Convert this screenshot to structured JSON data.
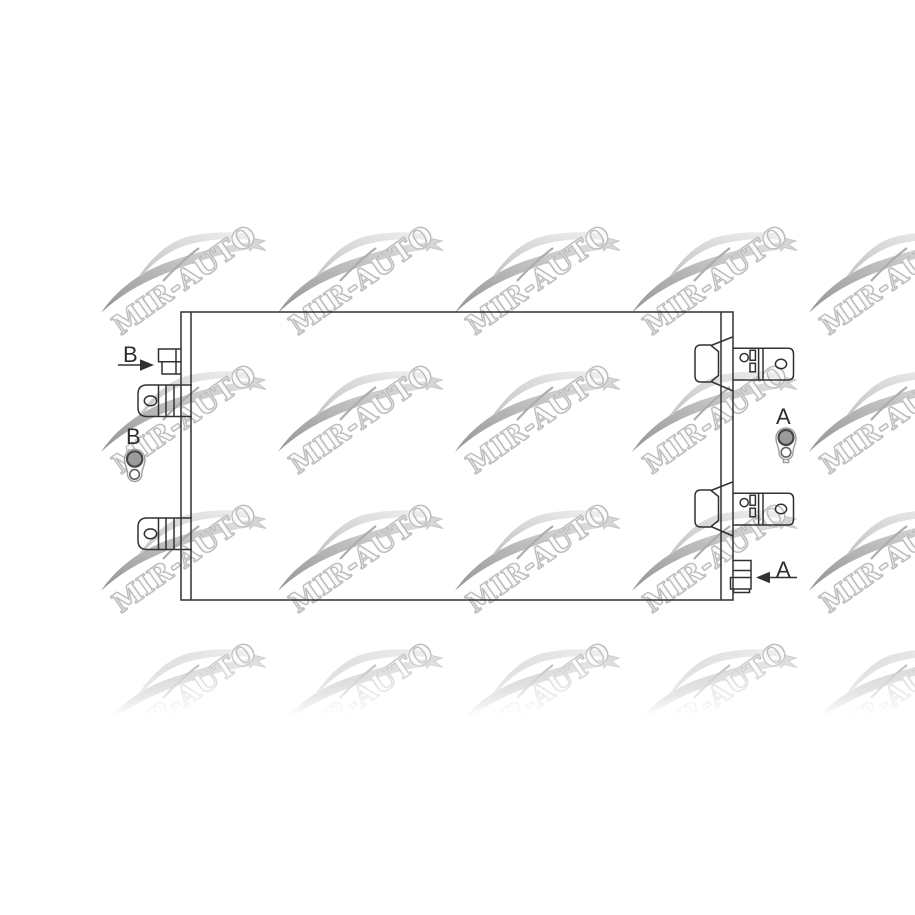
{
  "canvas": {
    "width": 915,
    "height": 915,
    "background": "#ffffff"
  },
  "watermark": {
    "text": "MIR-AUTO",
    "outline_color": "#bcbcbc",
    "swoosh_dark": "#949494",
    "swoosh_light": "#e3e3e3",
    "rows": 4,
    "cols": 5
  },
  "diagram": {
    "line_color": "#313131",
    "callouts": {
      "b_fitting_label": "B",
      "b_valve_label": "B",
      "a_valve_label": "A",
      "a_fitting_label": "A"
    }
  }
}
